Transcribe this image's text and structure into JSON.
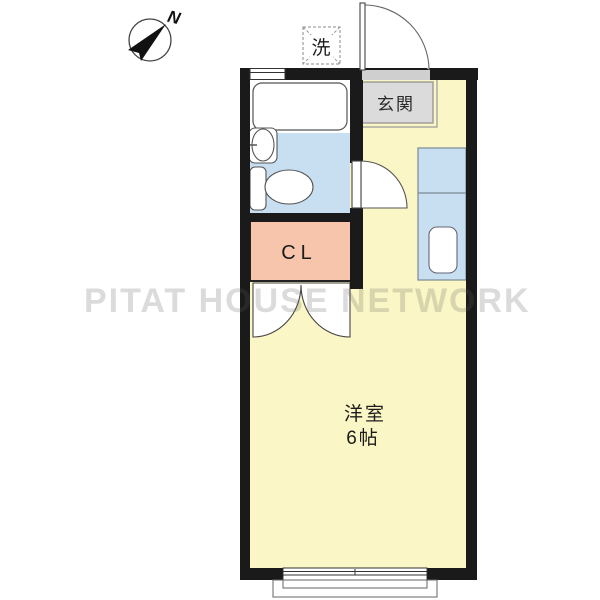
{
  "compass": {
    "label": "N"
  },
  "fixtures": {
    "washer_label": "洗",
    "entrance_label": "玄関",
    "closet_label": "CL"
  },
  "room": {
    "name": "洋室",
    "size": "6帖"
  },
  "watermark": "PITAT HOUSE NETWORK",
  "colors": {
    "room": "#FBF6C5",
    "water": "#C8DFF1",
    "closet": "#F6C5AB",
    "entrance_floor": "#DBDBDB",
    "wall": "#1A1A1A"
  }
}
